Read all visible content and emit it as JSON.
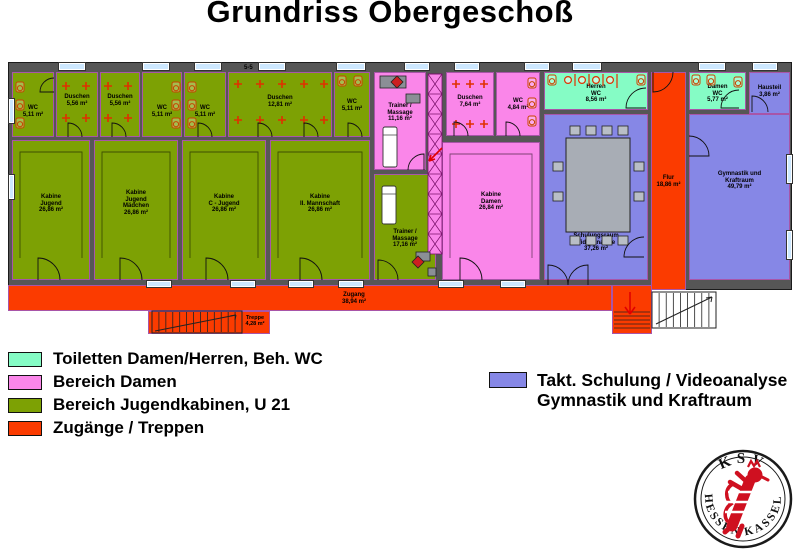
{
  "title": "Grundriss Obergeschoß",
  "colors": {
    "wall": "#565656",
    "green": "#7da104",
    "pink": "#fa86e9",
    "teal": "#85fcc5",
    "orange": "#fb3b00",
    "purple": "#8687e6",
    "window": "#cde8ff",
    "room_border": "#a855a8",
    "fixture_red": "#e03000",
    "logo_red": "#cf1020"
  },
  "legend_left": {
    "items": [
      {
        "label": "Toiletten Damen/Herren, Beh. WC",
        "color_key": "teal"
      },
      {
        "label": "Bereich Damen",
        "color_key": "pink"
      },
      {
        "label": "Bereich Jugendkabinen, U 21",
        "color_key": "green"
      },
      {
        "label": "Zugänge / Treppen",
        "color_key": "orange"
      }
    ]
  },
  "legend_right": {
    "color_key": "purple",
    "line1": "Takt. Schulung / Videoanalyse",
    "line2": "Gymnastik und Kraftraum"
  },
  "logo": {
    "top": "KSV",
    "bottom_left": "HESSEN",
    "bottom_right": "KASSEL"
  },
  "floorplan": {
    "section_marker": "5-5",
    "rooms": [
      {
        "id": "wc-1",
        "fill": "green",
        "x": 4,
        "y": 10,
        "w": 42,
        "h": 65,
        "ly": 0.6,
        "lines": [
          "WC",
          "5,11 m²"
        ]
      },
      {
        "id": "duschen-1",
        "fill": "green",
        "x": 48,
        "y": 10,
        "w": 42,
        "h": 65,
        "ly": 0.43,
        "lines": [
          "Duschen",
          "5,56 m²"
        ]
      },
      {
        "id": "duschen-2",
        "fill": "green",
        "x": 92,
        "y": 10,
        "w": 40,
        "h": 65,
        "ly": 0.43,
        "lines": [
          "Duschen",
          "5,56 m²"
        ]
      },
      {
        "id": "wc-2",
        "fill": "green",
        "x": 134,
        "y": 10,
        "w": 40,
        "h": 65,
        "ly": 0.6,
        "lines": [
          "WC",
          "5,11 m²"
        ]
      },
      {
        "id": "wc-3",
        "fill": "green",
        "x": 176,
        "y": 10,
        "w": 42,
        "h": 65,
        "ly": 0.6,
        "lines": [
          "WC",
          "5,11 m²"
        ]
      },
      {
        "id": "duschen-3",
        "fill": "green",
        "x": 220,
        "y": 10,
        "w": 104,
        "h": 65,
        "ly": 0.45,
        "lines": [
          "Duschen",
          "12,81 m²"
        ]
      },
      {
        "id": "wc-4",
        "fill": "green",
        "x": 326,
        "y": 10,
        "w": 36,
        "h": 65,
        "ly": 0.5,
        "lines": [
          "WC",
          "5,11 m²"
        ]
      },
      {
        "id": "kabine-jugend",
        "fill": "green",
        "x": 4,
        "y": 78,
        "w": 78,
        "h": 140,
        "ly": 0.45,
        "lines": [
          "Kabine",
          "Jugend",
          "26,86 m²"
        ]
      },
      {
        "id": "kabine-jugend-maedchen",
        "fill": "green",
        "x": 86,
        "y": 78,
        "w": 84,
        "h": 140,
        "ly": 0.45,
        "lines": [
          "Kabine",
          "Jugend",
          "Mädchen",
          "26,86 m²"
        ]
      },
      {
        "id": "kabine-c-jugend",
        "fill": "green",
        "x": 174,
        "y": 78,
        "w": 84,
        "h": 140,
        "ly": 0.45,
        "lines": [
          "Kabine",
          "C - Jugend",
          "26,86 m²"
        ]
      },
      {
        "id": "kabine-2-mannschaft",
        "fill": "green",
        "x": 262,
        "y": 78,
        "w": 100,
        "h": 140,
        "ly": 0.45,
        "lines": [
          "Kabine",
          "II. Mannschaft",
          "26,86 m²"
        ]
      },
      {
        "id": "trainer-massage-1",
        "fill": "pink",
        "x": 366,
        "y": 10,
        "w": 52,
        "h": 98,
        "ly": 0.41,
        "lines": [
          "Trainer /",
          "Massage",
          "11,16 m²"
        ]
      },
      {
        "id": "duschen-damen",
        "fill": "pink",
        "x": 438,
        "y": 10,
        "w": 48,
        "h": 64,
        "ly": 0.45,
        "lines": [
          "Duschen",
          "7,64 m²"
        ]
      },
      {
        "id": "wc-damen",
        "fill": "pink",
        "x": 488,
        "y": 10,
        "w": 44,
        "h": 64,
        "ly": 0.5,
        "lines": [
          "WC",
          "4,84 m²"
        ]
      },
      {
        "id": "trainer-massage-2",
        "fill": "green",
        "x": 366,
        "y": 112,
        "w": 62,
        "h": 106,
        "ly": 0.61,
        "lines": [
          "Trainer /",
          "Massage",
          "17,16 m²"
        ]
      },
      {
        "id": "kabine-damen",
        "fill": "pink",
        "x": 434,
        "y": 80,
        "w": 98,
        "h": 138,
        "ly": 0.43,
        "lines": [
          "Kabine",
          "Damen",
          "26,84 m²"
        ]
      },
      {
        "id": "herren-wc",
        "fill": "teal",
        "x": 536,
        "y": 10,
        "w": 104,
        "h": 38,
        "ly": 0.55,
        "lines": [
          "Herren",
          "WC",
          "8,56 m²"
        ]
      },
      {
        "id": "flur",
        "fill": "orange",
        "x": 643,
        "y": 10,
        "w": 35,
        "h": 218,
        "ly": 0.5,
        "lines": [
          "Flur",
          "18,86 m²"
        ]
      },
      {
        "id": "damen-wc",
        "fill": "teal",
        "x": 681,
        "y": 10,
        "w": 57,
        "h": 38,
        "ly": 0.55,
        "lines": [
          "Damen",
          "WC",
          "5,77 m²"
        ]
      },
      {
        "id": "hausteil",
        "fill": "purple",
        "x": 741,
        "y": 10,
        "w": 41,
        "h": 42,
        "ly": 0.45,
        "lines": [
          "Hausteil",
          "3,86 m²"
        ]
      },
      {
        "id": "schulungsraum",
        "fill": "purple",
        "x": 536,
        "y": 52,
        "w": 104,
        "h": 166,
        "ly": 0.77,
        "lines": [
          "Schulungsraum",
          "Videoanalyse",
          "37,26 m²"
        ]
      },
      {
        "id": "gymnastik-kraftraum",
        "fill": "purple",
        "x": 681,
        "y": 52,
        "w": 101,
        "h": 166,
        "ly": 0.4,
        "lines": [
          "Gymnastik und",
          "Kraftraum",
          "49,79 m²"
        ]
      },
      {
        "id": "zugang",
        "fill": "orange",
        "x": 0,
        "y": 223,
        "w": 604,
        "h": 26,
        "ly": 0.5,
        "lx": 315,
        "lines": [
          "Zugang",
          "38,94 m²"
        ]
      },
      {
        "id": "junction",
        "fill": "orange",
        "x": 604,
        "y": 223,
        "w": 40,
        "h": 49,
        "lines": []
      },
      {
        "id": "treppe-stub",
        "fill": "orange",
        "x": 140,
        "y": 249,
        "w": 122,
        "h": 23,
        "lines": []
      }
    ],
    "stair_labels": [
      {
        "id": "treppe-1",
        "lines": [
          "Treppe",
          "4,28 m²"
        ],
        "x": 230,
        "y": 253,
        "w": 34
      },
      {
        "id": "treppe-2",
        "lines": [
          "Treppe",
          "3,86 m²"
        ],
        "x": 672,
        "y": 241,
        "w": 34
      }
    ],
    "windows": [
      [
        50,
        0,
        28,
        9
      ],
      [
        134,
        0,
        28,
        9
      ],
      [
        186,
        0,
        28,
        9
      ],
      [
        250,
        0,
        28,
        9
      ],
      [
        328,
        0,
        30,
        9
      ],
      [
        396,
        0,
        26,
        9
      ],
      [
        446,
        0,
        26,
        9
      ],
      [
        516,
        0,
        26,
        9
      ],
      [
        564,
        0,
        30,
        9
      ],
      [
        690,
        0,
        28,
        9
      ],
      [
        744,
        0,
        26,
        9
      ],
      [
        0,
        36,
        7,
        26
      ],
      [
        0,
        112,
        7,
        26
      ],
      [
        778,
        92,
        7,
        30
      ],
      [
        778,
        168,
        7,
        30
      ],
      [
        138,
        218,
        26,
        8
      ],
      [
        222,
        218,
        26,
        8
      ],
      [
        280,
        218,
        26,
        8
      ],
      [
        330,
        218,
        26,
        8
      ],
      [
        430,
        218,
        26,
        8
      ],
      [
        492,
        218,
        26,
        8
      ]
    ],
    "doors": [
      "M30 218 L30 196 A22 22 0 0 1 52 218",
      "M112 218 L112 196 A22 22 0 0 1 134 218",
      "M198 218 L198 196 A22 22 0 0 1 220 218",
      "M292 218 L292 196 A22 22 0 0 1 314 218",
      "M370 218 L370 198 A20 20 0 0 1 390 218",
      "M452 218 L452 196 A22 22 0 0 1 474 218",
      "M638 46 L618 46 A20 20 0 0 1 638 26",
      "M731 46 L713 46 A18 18 0 0 1 731 28",
      "M645 10 L645 30 A20 20 0 0 0 665 10",
      "M681 94 L701 94 A20 20 0 0 0 681 74",
      "M744 50 L744 34 A16 16 0 0 1 760 50",
      "M636 195 L616 195 A20 20 0 0 1 636 175",
      "M540 223 L540 203 A20 20 0 0 1 560 223",
      "M580 223 L580 203 A20 20 0 0 0 560 223",
      "M46 30 L32 30 A14 14 0 0 1 46 16",
      "M60 75 L60 61 A14 14 0 0 1 74 75",
      "M104 75 L104 61 A14 14 0 0 1 118 75",
      "M190 75 L190 61 A14 14 0 0 1 204 75",
      "M250 75 L250 61 A14 14 0 0 1 264 75",
      "M296 75 L296 61 A14 14 0 0 1 310 75",
      "M340 75 L340 61 A14 14 0 0 1 354 75",
      "M446 74 L446 60 A14 14 0 0 1 460 74",
      "M498 74 L498 60 A14 14 0 0 1 512 74",
      "M416 108 L416 92 A16 16 0 0 0 400 108"
    ],
    "benches": [
      "M12 196 L12 90 L74 90 L74 196",
      "M94 196 L94 90 L162 90 L162 196",
      "M182 196 L182 90 L250 90 L250 196",
      "M270 196 L270 90 L354 90 L354 196",
      "M442 196 L442 92 L524 92 L524 196"
    ],
    "shower_crosses": [
      [
        58,
        24
      ],
      [
        78,
        24
      ],
      [
        58,
        56
      ],
      [
        78,
        56
      ],
      [
        100,
        24
      ],
      [
        120,
        24
      ],
      [
        100,
        56
      ],
      [
        120,
        56
      ],
      [
        230,
        22
      ],
      [
        252,
        22
      ],
      [
        274,
        22
      ],
      [
        296,
        22
      ],
      [
        316,
        22
      ],
      [
        230,
        58
      ],
      [
        252,
        58
      ],
      [
        274,
        58
      ],
      [
        296,
        58
      ],
      [
        316,
        58
      ],
      [
        448,
        22
      ],
      [
        462,
        22
      ],
      [
        476,
        22
      ],
      [
        448,
        62
      ],
      [
        462,
        62
      ],
      [
        476,
        62
      ]
    ],
    "toilets": [
      [
        8,
        20
      ],
      [
        8,
        38
      ],
      [
        8,
        56
      ],
      [
        164,
        20
      ],
      [
        164,
        38
      ],
      [
        164,
        56
      ],
      [
        180,
        20
      ],
      [
        180,
        38
      ],
      [
        180,
        56
      ],
      [
        330,
        14
      ],
      [
        346,
        14
      ],
      [
        520,
        16
      ],
      [
        520,
        36
      ],
      [
        520,
        54
      ],
      [
        540,
        13
      ],
      [
        629,
        13
      ],
      [
        684,
        13
      ],
      [
        699,
        13
      ],
      [
        726,
        15
      ]
    ],
    "urinals": [
      [
        560,
        18
      ],
      [
        574,
        18
      ],
      [
        588,
        18
      ],
      [
        602,
        18
      ]
    ],
    "red_dividers": [
      [
        567,
        12,
        567,
        24
      ],
      [
        581,
        12,
        581,
        24
      ],
      [
        595,
        12,
        595,
        24
      ],
      [
        609,
        12,
        609,
        26
      ]
    ],
    "lockers": {
      "x": 420,
      "y": 12,
      "w": 14,
      "cell": 20,
      "n": 9
    },
    "stairs": [
      {
        "x": 144,
        "y": 249,
        "w": 90,
        "h": 22,
        "n": 13,
        "diag": [
          147,
          269,
          228,
          253
        ],
        "fillKey": null
      },
      {
        "x": 644,
        "y": 230,
        "w": 64,
        "h": 36,
        "n": 9,
        "diag": [
          648,
          262,
          704,
          235
        ],
        "fillKey": "white"
      }
    ],
    "shaft_treads": {
      "x": 606,
      "y": 250,
      "w": 36,
      "n": 5,
      "step": 4
    },
    "red_arrows": [
      "M434 86 L421 99 M421 99 L427 97 M421 99 L423 93",
      "M622 230 L622 252 M622 252 L617 245 M622 252 L627 245"
    ],
    "furniture": {
      "table": {
        "x": 558,
        "y": 76,
        "w": 64,
        "h": 94
      },
      "chairs": [
        [
          562,
          64
        ],
        [
          578,
          64
        ],
        [
          594,
          64
        ],
        [
          610,
          64
        ],
        [
          562,
          174
        ],
        [
          578,
          174
        ],
        [
          594,
          174
        ],
        [
          610,
          174
        ],
        [
          545,
          100
        ],
        [
          545,
          130
        ],
        [
          626,
          100
        ],
        [
          626,
          130
        ]
      ],
      "beds": [
        [
          375,
          65,
          14,
          40
        ],
        [
          374,
          124,
          14,
          38
        ]
      ],
      "desks": [
        [
          372,
          14,
          26,
          12
        ],
        [
          398,
          32,
          14,
          9
        ],
        [
          408,
          190,
          14,
          9
        ],
        [
          420,
          206,
          8,
          8
        ]
      ],
      "diamonds": [
        [
          389,
          20
        ],
        [
          410,
          200
        ]
      ]
    }
  }
}
